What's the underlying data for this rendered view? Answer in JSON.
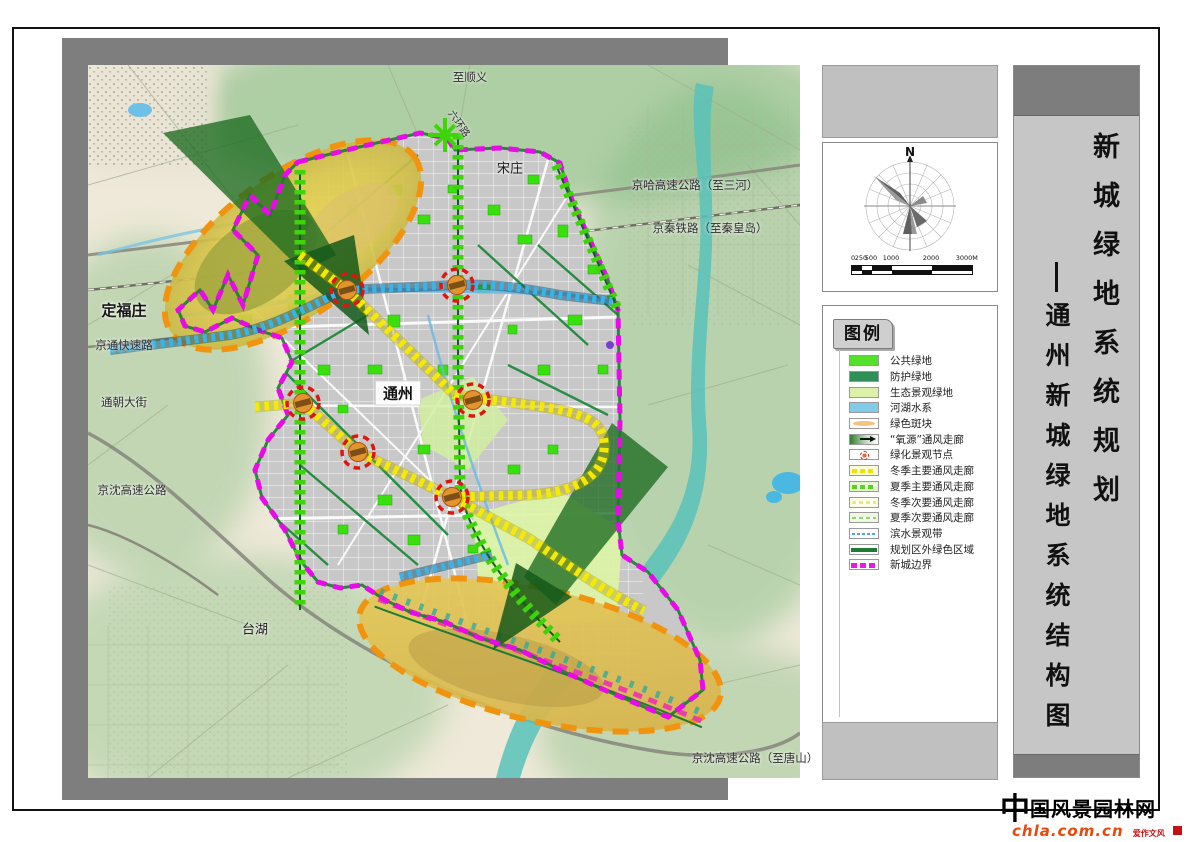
{
  "map": {
    "labels": [
      {
        "text": "至顺义",
        "x": 382,
        "y": 12,
        "cls": "road"
      },
      {
        "text": "六环路",
        "x": 372,
        "y": 58,
        "cls": "road-v"
      },
      {
        "text": "宋庄",
        "x": 422,
        "y": 102,
        "cls": "town"
      },
      {
        "text": "京哈高速公路（至三河）",
        "x": 607,
        "y": 120,
        "cls": "road"
      },
      {
        "text": "京秦铁路（至秦皇岛）",
        "x": 622,
        "y": 163,
        "cls": "road"
      },
      {
        "text": "定福庄",
        "x": 36,
        "y": 245,
        "cls": "town-lg"
      },
      {
        "text": "京通快速路",
        "x": 36,
        "y": 280,
        "cls": "road"
      },
      {
        "text": "通朝大街",
        "x": 36,
        "y": 337,
        "cls": "road"
      },
      {
        "text": "京沈高速公路",
        "x": 44,
        "y": 425,
        "cls": "road"
      },
      {
        "text": "通州",
        "x": 310,
        "y": 328,
        "cls": "city"
      },
      {
        "text": "台湖",
        "x": 167,
        "y": 563,
        "cls": "town"
      },
      {
        "text": "京沈高速公路（至唐山）",
        "x": 667,
        "y": 693,
        "cls": "road"
      }
    ]
  },
  "compass": {
    "north_label": "N",
    "scale_ticks": [
      "0",
      "250",
      "500",
      "1000",
      "2000",
      "3000M"
    ]
  },
  "legend": {
    "title": "图例",
    "items": [
      {
        "label": "公共绿地",
        "type": "public-green"
      },
      {
        "label": "防护绿地",
        "type": "protective-green"
      },
      {
        "label": "生态景观绿地",
        "type": "eco-green"
      },
      {
        "label": "河湖水系",
        "type": "water"
      },
      {
        "label": "绿色斑块",
        "type": "green-patch"
      },
      {
        "label": "“氧源”通风走廊",
        "type": "oxygen-corridor"
      },
      {
        "label": "绿化景观节点",
        "type": "landscape-node"
      },
      {
        "label": "冬季主要通风走廊",
        "type": "winter-main"
      },
      {
        "label": "夏季主要通风走廊",
        "type": "summer-main"
      },
      {
        "label": "冬季次要通风走廊",
        "type": "winter-minor"
      },
      {
        "label": "夏季次要通风走廊",
        "type": "summer-minor"
      },
      {
        "label": "滨水景观带",
        "type": "waterfront-belt"
      },
      {
        "label": "规划区外绿色区域",
        "type": "outside-green"
      },
      {
        "label": "新城边界",
        "type": "city-boundary"
      }
    ]
  },
  "title_block": {
    "main": "新城绿地系统规划",
    "subtitle": "通州新城绿地系统结构图"
  },
  "watermark": {
    "logo_char": "中",
    "site_name_rest": "国风景园林网",
    "url": "chla.com.cn",
    "slogan": "爱作文风"
  },
  "colors": {
    "boundary_magenta": "#e80ae8",
    "public_green": "#55e02a",
    "protective_green": "#2f8f55",
    "eco_green": "#dcf0a8",
    "water_blue": "#7ec8e8",
    "river_teal": "#58c2ba",
    "winter_corridor_yellow": "#f4ea05",
    "summer_corridor_green": "#3fd40a",
    "green_patch_ring_orange": "#f09410",
    "node_red": "#e01510",
    "oxygen_arrow_green": "#1c6b20"
  }
}
